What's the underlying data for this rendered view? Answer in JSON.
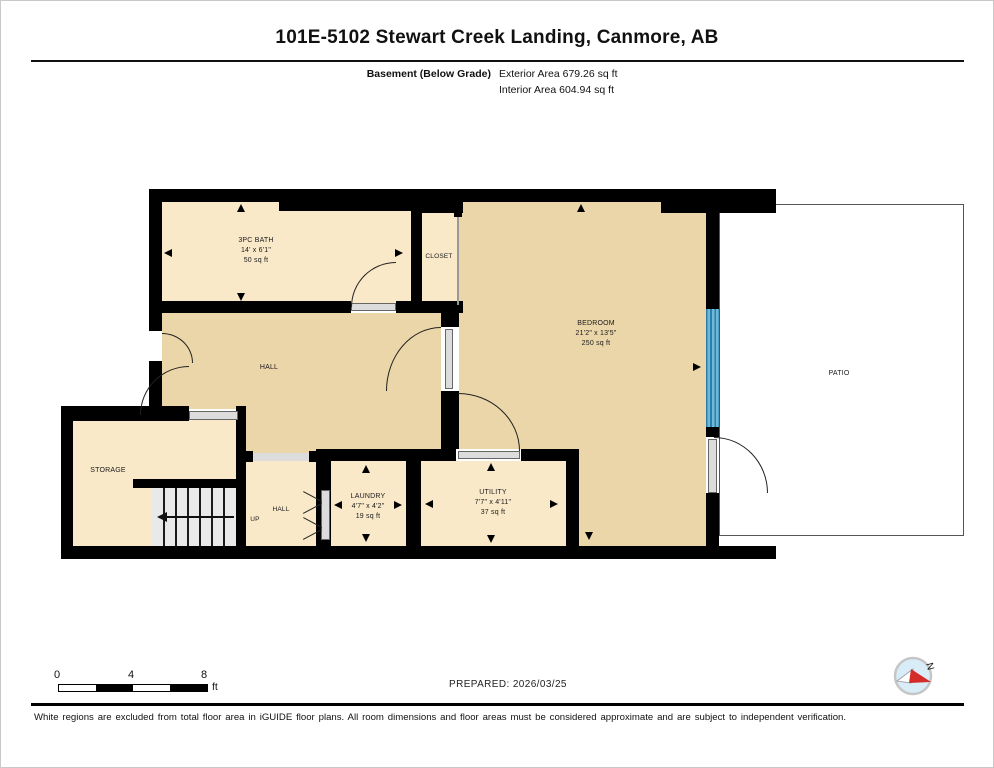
{
  "page": {
    "title": "101E-5102 Stewart Creek Landing, Canmore, AB"
  },
  "floor_info": {
    "floor_label": "Basement (Below Grade)",
    "exterior_area": "Exterior Area 679.26 sq ft",
    "interior_area": "Interior Area 604.94 sq ft"
  },
  "rooms": {
    "bath": {
      "name": "3PC BATH",
      "dims": "14' x 6'1\"",
      "area": "50 sq ft"
    },
    "closet": {
      "name": "CLOSET"
    },
    "bedroom": {
      "name": "BEDROOM",
      "dims": "21'2\" x 13'5\"",
      "area": "250 sq ft"
    },
    "hall_upper": {
      "name": "HALL"
    },
    "hall_lower": {
      "name": "HALL"
    },
    "stairs": {
      "label": "UP"
    },
    "storage": {
      "name": "STORAGE"
    },
    "laundry": {
      "name": "LAUNDRY",
      "dims": "4'7\" x 4'2\"",
      "area": "19 sq ft"
    },
    "utility": {
      "name": "UTILITY",
      "dims": "7'7\" x 4'11\"",
      "area": "37 sq ft"
    },
    "patio": {
      "name": "PATIO"
    }
  },
  "scale_bar": {
    "ticks": [
      "0",
      "4",
      "8"
    ],
    "unit": "ft"
  },
  "footer": {
    "prepared": "PREPARED: 2026/03/25",
    "disclaimer": "White regions are excluded from total floor area in iGUIDE floor plans. All room dimensions and floor areas must be considered approximate and are subject to independent verification."
  },
  "compass": {
    "north_label": "N"
  },
  "colors": {
    "room_fill_dark": "#EBD6A9",
    "room_fill_light": "#FAE9C9",
    "wall": "#000000",
    "window_blue": "#6CB9DC",
    "window_blue_dark": "#2E7FA8",
    "compass_blue": "#D8EDF8",
    "compass_red": "#D42B2B"
  }
}
